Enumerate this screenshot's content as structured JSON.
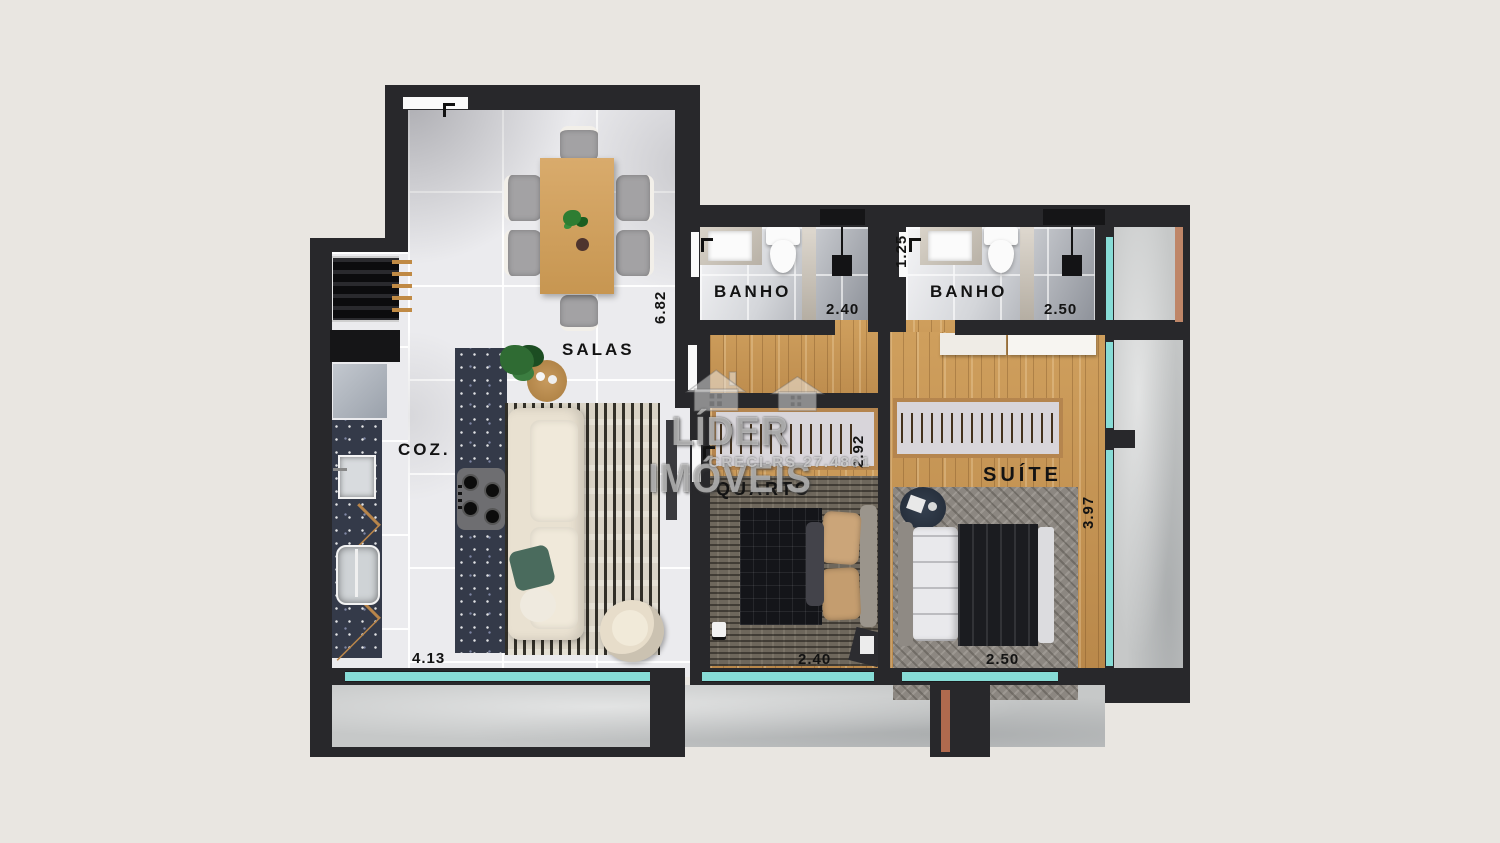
{
  "watermark": {
    "brand": "LÍDER IMÓVEIS",
    "creci": "CRECI-RS 27.4861"
  },
  "rooms": {
    "salas": {
      "label": "SALAS",
      "depth": "6.82",
      "width": "4.13"
    },
    "cozinha": {
      "label": "COZ."
    },
    "banho1": {
      "label": "BANHO",
      "width": "2.40"
    },
    "banho2": {
      "label": "BANHO",
      "width": "2.50",
      "entry_width": "1.25"
    },
    "quarto": {
      "label": "QUARTO",
      "width": "2.40",
      "depth": "2.92"
    },
    "suite": {
      "label": "SUÍTE",
      "width": "2.50",
      "depth": "3.97"
    }
  },
  "colors": {
    "background": "#e9e6e1",
    "wall": "#28282b",
    "window_glass": "#87dcd6",
    "wood_floor": "#c2914f",
    "countertop": "#343a49",
    "tile": "#ebebee",
    "concrete": "#c6c8c8",
    "terracotta": "#bf8668"
  }
}
